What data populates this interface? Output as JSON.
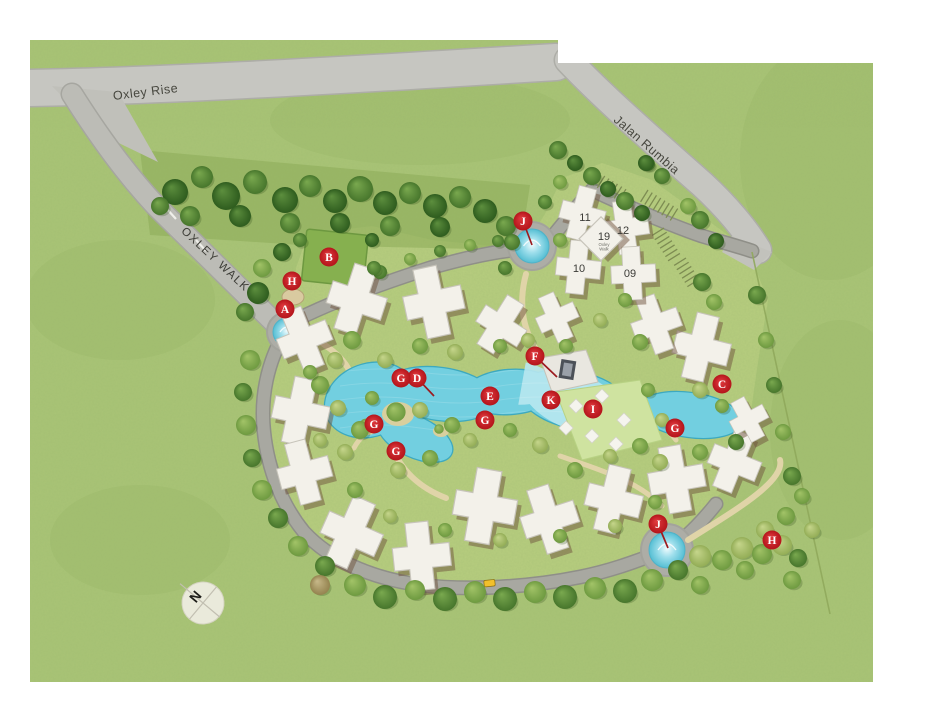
{
  "map": {
    "roads": {
      "oxley_rise": "Oxley Rise",
      "oxley_walk": "OXLEY WALK",
      "jalan_rumbia": "Jalan Rumbia"
    },
    "buildings": [
      {
        "label": "11",
        "x": 585,
        "y": 221
      },
      {
        "label": "12",
        "x": 623,
        "y": 234
      },
      {
        "label": "19",
        "x": 604,
        "y": 240,
        "sub": "Oxley Walk"
      },
      {
        "label": "10",
        "x": 579,
        "y": 272
      },
      {
        "label": "09",
        "x": 630,
        "y": 277
      }
    ],
    "markers": [
      {
        "letter": "A",
        "x": 285,
        "y": 309
      },
      {
        "letter": "B",
        "x": 329,
        "y": 257
      },
      {
        "letter": "C",
        "x": 722,
        "y": 384
      },
      {
        "letter": "D",
        "x": 417,
        "y": 378,
        "lx": 434,
        "ly": 396
      },
      {
        "letter": "E",
        "x": 490,
        "y": 396
      },
      {
        "letter": "F",
        "x": 535,
        "y": 356,
        "lx": 557,
        "ly": 377
      },
      {
        "letter": "G",
        "x": 401,
        "y": 378
      },
      {
        "letter": "G",
        "x": 374,
        "y": 424
      },
      {
        "letter": "G",
        "x": 485,
        "y": 420
      },
      {
        "letter": "G",
        "x": 675,
        "y": 428
      },
      {
        "letter": "G",
        "x": 396,
        "y": 451
      },
      {
        "letter": "H",
        "x": 292,
        "y": 281
      },
      {
        "letter": "H",
        "x": 772,
        "y": 540
      },
      {
        "letter": "I",
        "x": 593,
        "y": 409
      },
      {
        "letter": "J",
        "x": 523,
        "y": 221,
        "lx": 532,
        "ly": 245
      },
      {
        "letter": "J",
        "x": 658,
        "y": 524,
        "lx": 668,
        "ly": 548
      },
      {
        "letter": "K",
        "x": 551,
        "y": 400
      }
    ],
    "compass": {
      "label": "N"
    },
    "colors": {
      "marker": "#c9252b",
      "pool": "#72cfe0",
      "grass": "#a9c476",
      "road": "#c4c4bf",
      "building": "#f3f1ea"
    }
  }
}
